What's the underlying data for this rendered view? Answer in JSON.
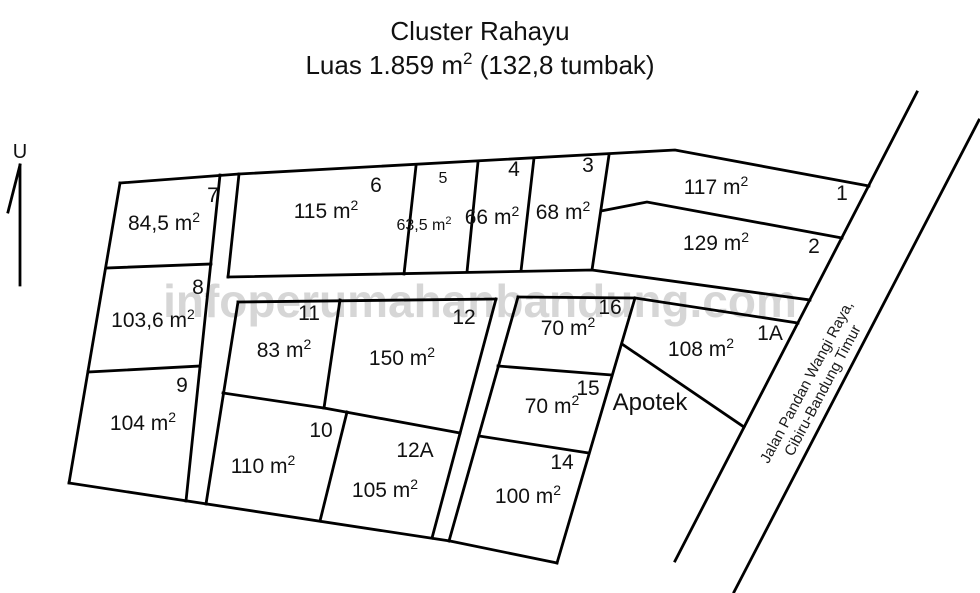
{
  "title": {
    "line1": "Cluster Rahayu",
    "line2_prefix": "Luas 1.859 m",
    "line2_sup": "2",
    "line2_suffix": " (132,8 tumbak)"
  },
  "north": {
    "label": "U"
  },
  "watermark": {
    "text": "infoperumahanbandung.com"
  },
  "road": {
    "name_line1": "Jalan Pandan Wangi Raya,",
    "name_line2": "Cibiru-Bandung Timur"
  },
  "apotek": {
    "label": "Apotek",
    "x": 650,
    "y": 410,
    "font": 24
  },
  "plan": {
    "stroke": "#000000",
    "lines": [
      {
        "name": "outer-top-boundary",
        "points": [
          [
            120,
            183
          ],
          [
            239,
            174
          ],
          [
            675,
            150
          ],
          [
            869,
            186
          ]
        ]
      },
      {
        "name": "outer-west-boundary",
        "points": [
          [
            120,
            183
          ],
          [
            69,
            483
          ]
        ]
      },
      {
        "name": "outer-bottom-boundary",
        "points": [
          [
            69,
            483
          ],
          [
            450,
            541
          ],
          [
            557,
            563
          ]
        ]
      },
      {
        "name": "left-column-east-edge",
        "points": [
          [
            220,
            175
          ],
          [
            186,
            501
          ]
        ]
      },
      {
        "name": "divider-lot7-lot8",
        "points": [
          [
            106,
            268
          ],
          [
            211,
            264
          ]
        ]
      },
      {
        "name": "divider-lot8-lot9",
        "points": [
          [
            88,
            372
          ],
          [
            200,
            366
          ]
        ]
      },
      {
        "name": "lot6-west-edge",
        "points": [
          [
            239,
            174
          ],
          [
            228,
            277
          ]
        ]
      },
      {
        "name": "row1-bottom-boundary",
        "points": [
          [
            228,
            277
          ],
          [
            592,
            270
          ],
          [
            810,
            300
          ]
        ]
      },
      {
        "name": "divider-lot6-lot5",
        "points": [
          [
            416,
            166
          ],
          [
            404,
            274
          ]
        ]
      },
      {
        "name": "divider-lot5-lot4",
        "points": [
          [
            478,
            162
          ],
          [
            467,
            272
          ]
        ]
      },
      {
        "name": "divider-lot4-lot3",
        "points": [
          [
            534,
            158
          ],
          [
            521,
            271
          ]
        ]
      },
      {
        "name": "lot3-east-edge",
        "points": [
          [
            609,
            155
          ],
          [
            592,
            270
          ]
        ]
      },
      {
        "name": "divider-lot1-lot2",
        "points": [
          [
            601,
            211
          ],
          [
            647,
            202
          ],
          [
            842,
            238
          ]
        ]
      },
      {
        "name": "road-west-line",
        "points": [
          [
            917,
            92
          ],
          [
            675,
            561
          ]
        ]
      },
      {
        "name": "road-east-line",
        "points": [
          [
            979,
            120
          ],
          [
            734,
            592
          ]
        ]
      },
      {
        "name": "mid-block-top-edge",
        "points": [
          [
            238,
            302
          ],
          [
            496,
            299
          ]
        ]
      },
      {
        "name": "mid-block-west-edge",
        "points": [
          [
            238,
            302
          ],
          [
            206,
            504
          ]
        ]
      },
      {
        "name": "mid-block-east-edge",
        "points": [
          [
            496,
            299
          ],
          [
            432,
            538
          ]
        ]
      },
      {
        "name": "divider-lot11-lot12",
        "points": [
          [
            340,
            300
          ],
          [
            324,
            408
          ]
        ]
      },
      {
        "name": "divider-lot11-lot10",
        "points": [
          [
            223,
            393
          ],
          [
            324,
            408
          ]
        ]
      },
      {
        "name": "divider-lot12-lot12A",
        "points": [
          [
            324,
            408
          ],
          [
            460,
            433
          ]
        ]
      },
      {
        "name": "divider-lot10-lot12A",
        "points": [
          [
            347,
            412
          ],
          [
            320,
            521
          ]
        ]
      },
      {
        "name": "right-block-west-edge",
        "points": [
          [
            518,
            297
          ],
          [
            449,
            541
          ]
        ]
      },
      {
        "name": "right-block-top-edge",
        "points": [
          [
            518,
            297
          ],
          [
            635,
            298
          ]
        ]
      },
      {
        "name": "right-block-east-edge",
        "points": [
          [
            635,
            298
          ],
          [
            557,
            563
          ]
        ]
      },
      {
        "name": "divider-lot16-lot15",
        "points": [
          [
            498,
            366
          ],
          [
            612,
            375
          ]
        ]
      },
      {
        "name": "divider-lot15-lot14",
        "points": [
          [
            479,
            436
          ],
          [
            589,
            453
          ]
        ]
      },
      {
        "name": "lot1A-top-edge",
        "points": [
          [
            635,
            298
          ],
          [
            798,
            323
          ]
        ]
      },
      {
        "name": "apotek-boundary",
        "points": [
          [
            622,
            344
          ],
          [
            744,
            427
          ]
        ]
      },
      {
        "name": "north-arrow-line",
        "points": [
          [
            20,
            165
          ],
          [
            20,
            285
          ]
        ],
        "w": 1.3
      },
      {
        "name": "north-arrow-barb",
        "points": [
          [
            20,
            165
          ],
          [
            8,
            212
          ]
        ],
        "w": 1.3
      }
    ],
    "lots": [
      {
        "number": "7",
        "area_m2": "84,5",
        "num_x": 213,
        "num_y": 202,
        "area_x": 164,
        "area_y": 230
      },
      {
        "number": "8",
        "area_m2": "103,6",
        "num_x": 198,
        "num_y": 294,
        "area_x": 153,
        "area_y": 327
      },
      {
        "number": "9",
        "area_m2": "104",
        "num_x": 182,
        "num_y": 392,
        "area_x": 143,
        "area_y": 430
      },
      {
        "number": "6",
        "area_m2": "115",
        "num_x": 376,
        "num_y": 192,
        "area_x": 326,
        "area_y": 218
      },
      {
        "number": "5",
        "area_m2": "63,5",
        "num_x": 443,
        "num_y": 183,
        "area_x": 424,
        "area_y": 230,
        "font": 16
      },
      {
        "number": "4",
        "area_m2": "66",
        "num_x": 514,
        "num_y": 176,
        "area_x": 492,
        "area_y": 224
      },
      {
        "number": "3",
        "area_m2": "68",
        "num_x": 588,
        "num_y": 172,
        "area_x": 563,
        "area_y": 219
      },
      {
        "number": "1",
        "area_m2": "117",
        "num_x": 842,
        "num_y": 200,
        "area_x": 716,
        "area_y": 194
      },
      {
        "number": "2",
        "area_m2": "129",
        "num_x": 814,
        "num_y": 253,
        "area_x": 716,
        "area_y": 250
      },
      {
        "number": "11",
        "area_m2": "83",
        "num_x": 309,
        "num_y": 320,
        "area_x": 284,
        "area_y": 357
      },
      {
        "number": "12",
        "area_m2": "150",
        "num_x": 464,
        "num_y": 324,
        "area_x": 402,
        "area_y": 365
      },
      {
        "number": "10",
        "area_m2": "110",
        "num_x": 321,
        "num_y": 437,
        "area_x": 263,
        "area_y": 473
      },
      {
        "number": "12A",
        "area_m2": "105",
        "num_x": 415,
        "num_y": 457,
        "area_x": 385,
        "area_y": 497
      },
      {
        "number": "16",
        "area_m2": "70",
        "num_x": 610,
        "num_y": 314,
        "area_x": 568,
        "area_y": 335
      },
      {
        "number": "15",
        "area_m2": "70",
        "num_x": 588,
        "num_y": 395,
        "area_x": 552,
        "area_y": 413
      },
      {
        "number": "14",
        "area_m2": "100",
        "num_x": 562,
        "num_y": 469,
        "area_x": 528,
        "area_y": 503
      },
      {
        "number": "1A",
        "area_m2": "108",
        "num_x": 770,
        "num_y": 340,
        "area_x": 701,
        "area_y": 356
      }
    ]
  }
}
